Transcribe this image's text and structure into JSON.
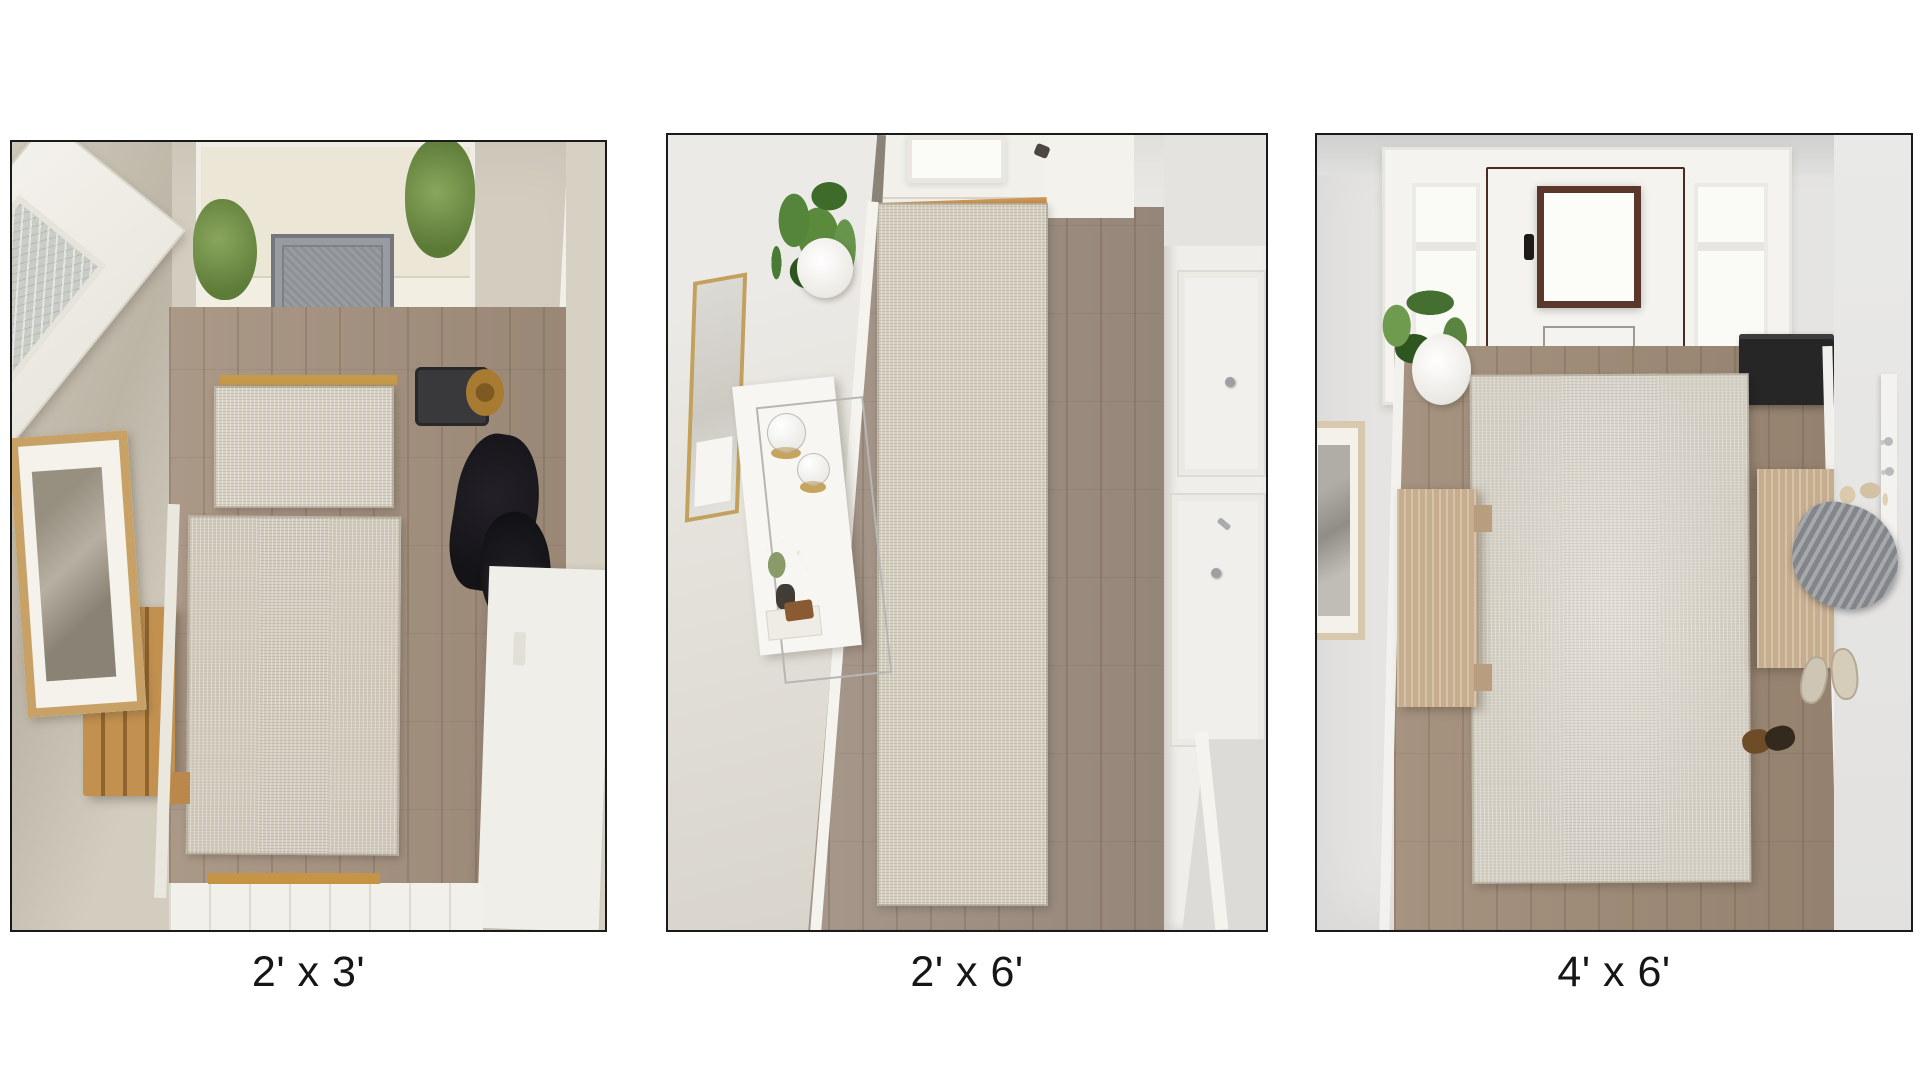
{
  "figure": {
    "name": "entryway-rug-size-comparison",
    "panel_count": 3,
    "background": "#ffffff"
  },
  "panels": [
    {
      "caption": "2' x 3'",
      "scene": {
        "view": "overhead entryway photo",
        "objects": [
          "open white front door with glass panel",
          "outdoor step with gray ornate doormat",
          "green bushes",
          "sidelight window",
          "gold threshold",
          "small beige doormat rug",
          "large layered beige rug",
          "wood plank floor",
          "slatted oak bench",
          "framed wall art",
          "black hanging coats",
          "black boot tray with straw hat",
          "brass wall hooks",
          "white trim"
        ]
      }
    },
    {
      "caption": "2' x 6'",
      "scene": {
        "view": "overhead hallway photo",
        "objects": [
          "white front door with frosted window",
          "door hinge",
          "wood threshold",
          "beige runner rug",
          "wood plank floor",
          "potted green plant in white pot",
          "gold framed leaning mirror",
          "white console table with chrome frame",
          "glass cloches on gold bases",
          "white flower sprigs in vase",
          "stacked books",
          "white closet doors with metal knobs",
          "baseboard trim"
        ]
      }
    },
    {
      "caption": "4' x 6'",
      "scene": {
        "view": "overhead entryway photo",
        "objects": [
          "brown front door with glass window",
          "white sidelight windows",
          "white door casing",
          "black storage bin",
          "large beige area rug",
          "wood plank floor",
          "snake plant in white pot",
          "framed wall art",
          "light oak bench left",
          "light oak bench right",
          "gray draped coat",
          "tan bag straps",
          "white hook rail with metal hooks",
          "light slip-on shoes",
          "dark loafers",
          "baseboard trim"
        ]
      }
    }
  ],
  "palette": {
    "page_background": "#ffffff",
    "photo_border": "#1a1a1a",
    "caption_text": "#161616",
    "rug_beige": "#d6d0c3",
    "floor_wood": "#9e8b7a",
    "wall_greige": "#d3cdc0",
    "wall_light": "#e7e5e1",
    "door_brown": "#6e4737",
    "door_white": "#f1f0ea",
    "bench_oak": "#c2914f",
    "bench_light_oak": "#c6ad8e",
    "plant_green": "#55853a",
    "doormat_gray": "#8d9196",
    "threshold_gold": "#c59a4b",
    "trim_white": "#f2f1ec",
    "mirror_gold": "#c2a05e",
    "coat_black": "#17161a",
    "garment_gray": "#8d9095"
  }
}
